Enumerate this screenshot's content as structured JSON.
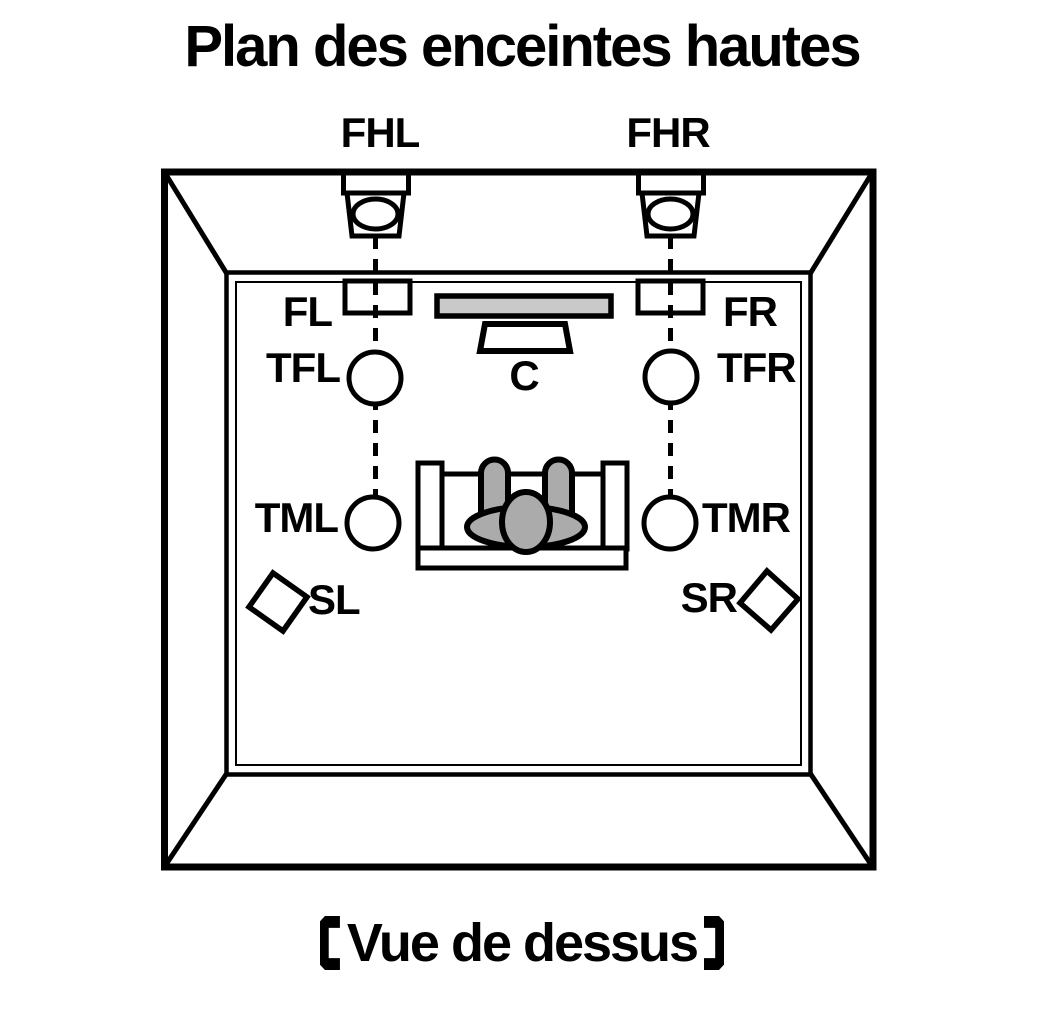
{
  "title": "Plan des enceintes hautes",
  "caption": {
    "left_bracket": "【",
    "text": "Vue de dessus",
    "right_bracket": "】"
  },
  "speaker_labels": {
    "fhl": "FHL",
    "fhr": "FHR",
    "fl": "FL",
    "fr": "FR",
    "tfl": "TFL",
    "tfr": "TFR",
    "c": "C",
    "tml": "TML",
    "tmr": "TMR",
    "sl": "SL",
    "sr": "SR"
  },
  "colors": {
    "line": "#000000",
    "background": "#ffffff",
    "tv_screen": "#c9c9c9",
    "person": "#ababab"
  }
}
